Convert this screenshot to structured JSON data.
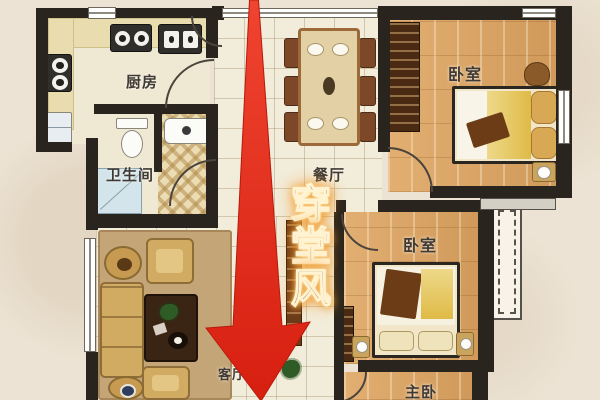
{
  "rooms": {
    "kitchen": {
      "label": "厨房"
    },
    "bathroom": {
      "label": "卫生间"
    },
    "dining": {
      "label": "餐厅"
    },
    "bedroom_top": {
      "label": "卧室"
    },
    "bedroom_middle": {
      "label": "卧室"
    },
    "master_bedroom": {
      "label": "主卧"
    },
    "living": {
      "label": "客厅"
    }
  },
  "annotation": {
    "text": "穿堂风",
    "meaning": "through-hall draft",
    "text_color": "#8a6126",
    "glow_color": "#f59b2a",
    "arrow_color": "#e2281a",
    "arrow_direction": "down"
  },
  "palette": {
    "wall": "#29241e",
    "wood_floor": "#dba76a",
    "tile_floor": "#f2ecda",
    "background": "#ece3d4"
  }
}
